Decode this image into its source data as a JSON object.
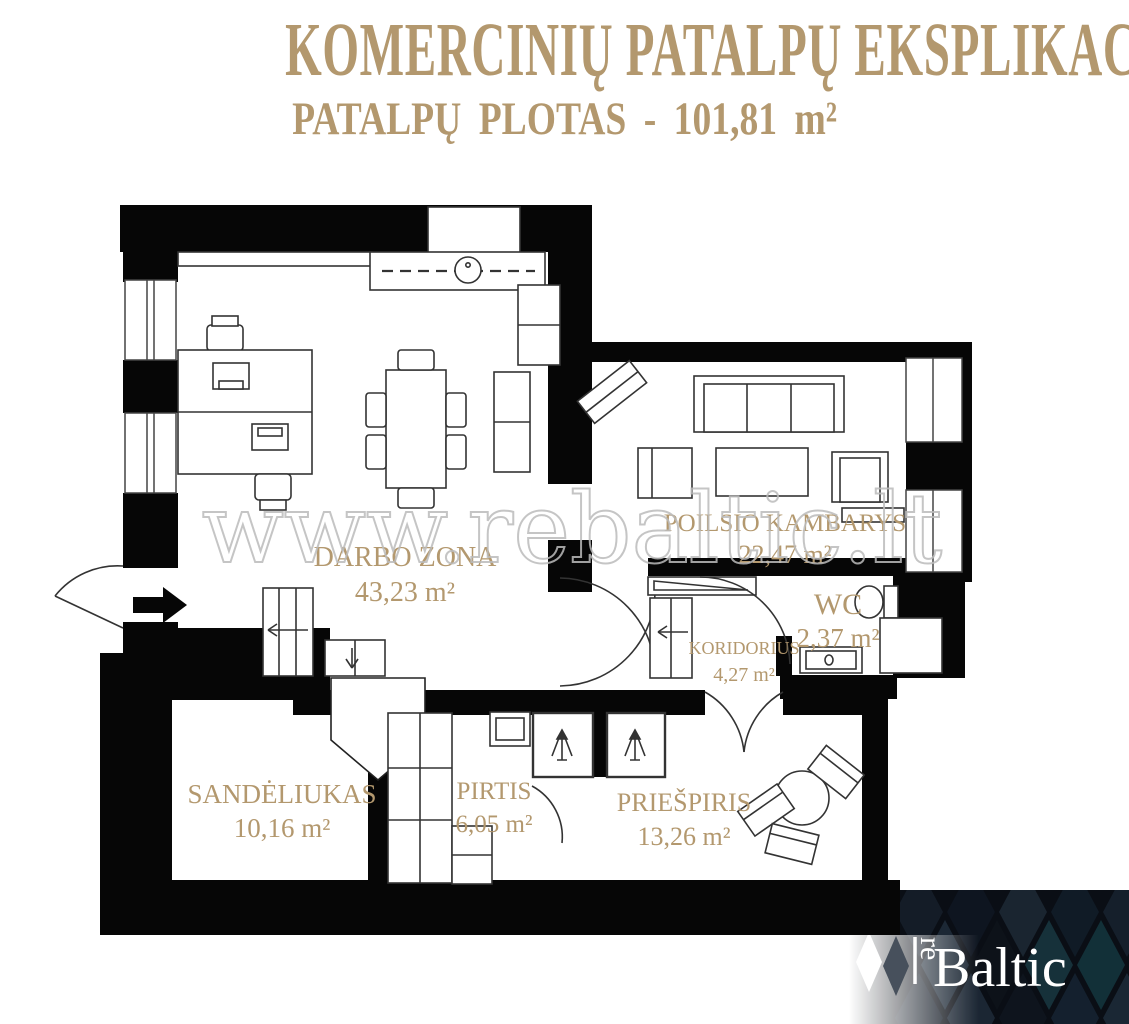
{
  "header": {
    "title_line1": "KOMERCINIŲ PATALPŲ EKSPLIKACIJA",
    "title_line2": "PATALPŲ PLOTAS - 101,81 m²",
    "text_color": "#b3986e"
  },
  "plan": {
    "watermark": "www.rebaltic.lt",
    "wall_color": "#060606",
    "label_color": "#b3986e",
    "rooms": [
      {
        "name": "DARBO ZONA",
        "area": "43,23 m²"
      },
      {
        "name": "POILSIO KAMBARYS",
        "area": "22,47 m²"
      },
      {
        "name": "WC",
        "area": "2,37 m²"
      },
      {
        "name": "KORIDORIUS",
        "area": "4,27 m²"
      },
      {
        "name": "SANDĖLIUKAS",
        "area": "10,16 m²"
      },
      {
        "name": "PIRTIS",
        "area": "6,05 m²"
      },
      {
        "name": "PRIEŠPIRIS",
        "area": "13,26 m²"
      }
    ]
  },
  "branding": {
    "logo_prefix": "re",
    "logo_suffix": "Baltic",
    "banner_bg": "#0a0e15",
    "text_color": "#ffffff"
  }
}
